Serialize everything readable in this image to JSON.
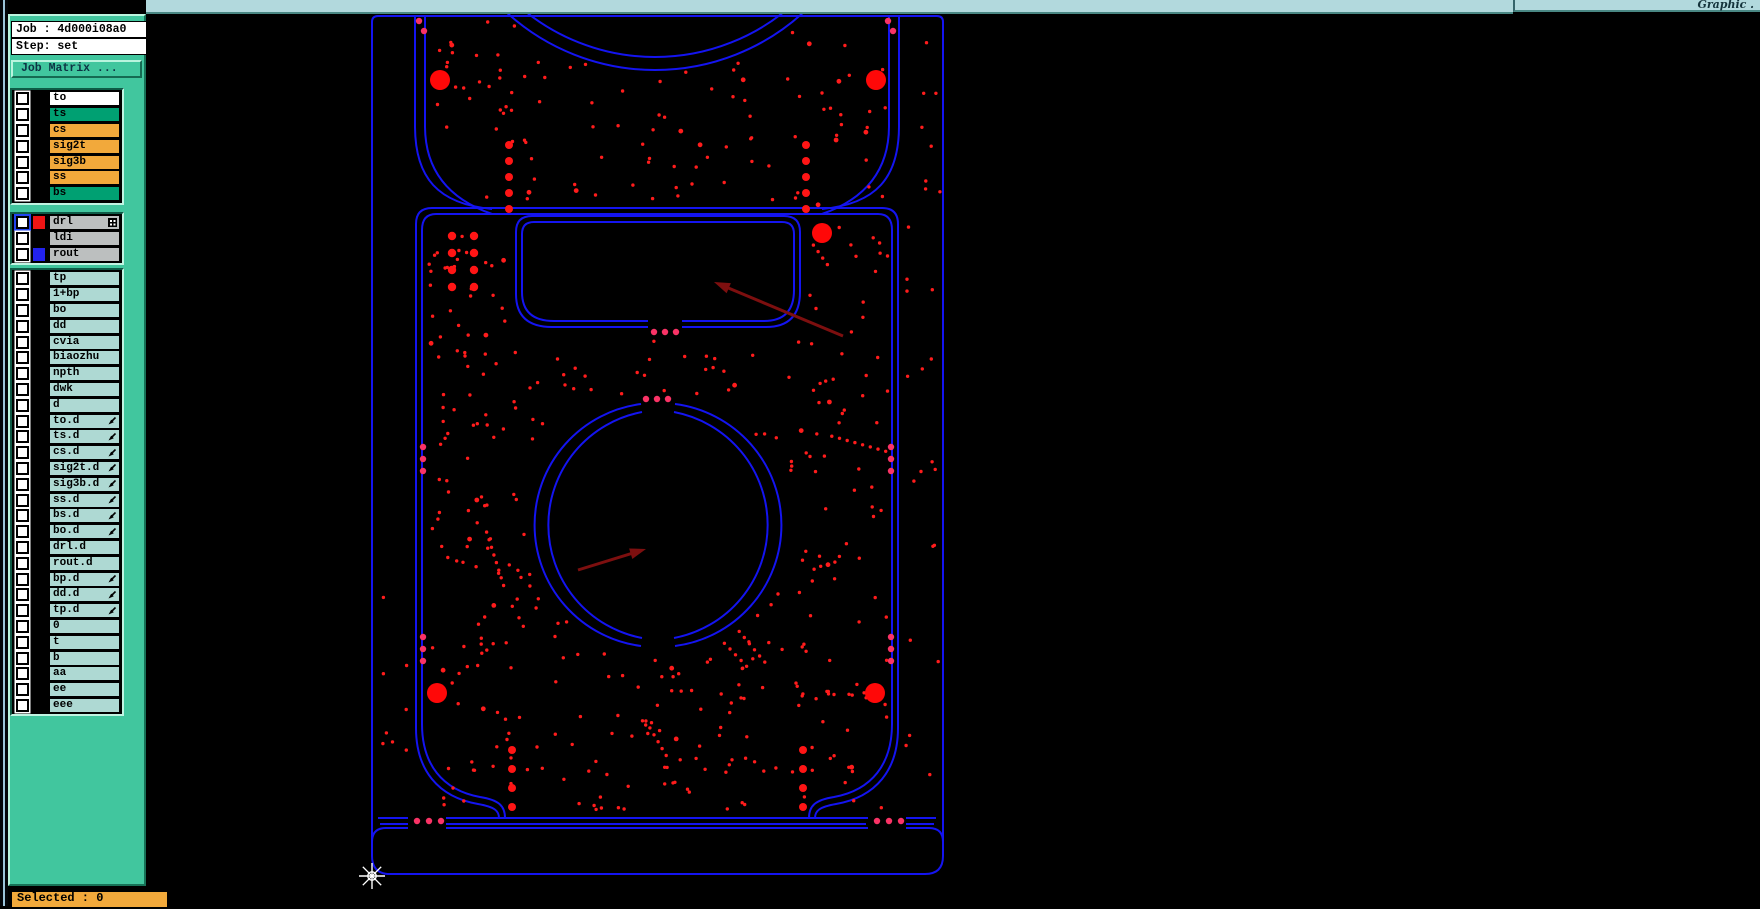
{
  "window": {
    "top_bar_right_label": "Graphic ."
  },
  "job_panel": {
    "job_line": "Job : 4d000i08a0",
    "step_line": "Step: set",
    "matrix_button_label": "Job Matrix ..."
  },
  "layers": {
    "groups": [
      {
        "name": "board-layers",
        "rows": [
          {
            "label": "to",
            "bg": "#ffffff"
          },
          {
            "label": "ts",
            "bg": "#00a072"
          },
          {
            "label": "cs",
            "bg": "#f2a93b"
          },
          {
            "label": "sig2t",
            "bg": "#f2a93b"
          },
          {
            "label": "sig3b",
            "bg": "#f2a93b"
          },
          {
            "label": "ss",
            "bg": "#f2a93b"
          },
          {
            "label": "bs",
            "bg": "#00a072"
          }
        ]
      },
      {
        "name": "drill-rout-layers",
        "rows": [
          {
            "label": "drl",
            "bg": "#bcbfbf",
            "swatch": "#ee1515",
            "selected": true,
            "icon": "grid"
          },
          {
            "label": "ldi",
            "bg": "#bcbfbf"
          },
          {
            "label": "rout",
            "bg": "#bcbfbf",
            "swatch": "#2222ee"
          }
        ]
      },
      {
        "name": "misc-layers",
        "rows": [
          {
            "label": "tp"
          },
          {
            "label": "1+bp"
          },
          {
            "label": "bo"
          },
          {
            "label": "dd"
          },
          {
            "label": "cvia"
          },
          {
            "label": "biaozhu"
          },
          {
            "label": "npth"
          },
          {
            "label": "dwk"
          },
          {
            "label": "d"
          },
          {
            "label": "to.d",
            "icon": "pen"
          },
          {
            "label": "ts.d",
            "icon": "pen"
          },
          {
            "label": "cs.d",
            "icon": "pen"
          },
          {
            "label": "sig2t.d",
            "icon": "pen"
          },
          {
            "label": "sig3b.d",
            "icon": "pen"
          },
          {
            "label": "ss.d",
            "icon": "pen"
          },
          {
            "label": "bs.d",
            "icon": "pen"
          },
          {
            "label": "bo.d",
            "icon": "pen"
          },
          {
            "label": "drl.d"
          },
          {
            "label": "rout.d"
          },
          {
            "label": "bp.d",
            "icon": "pen"
          },
          {
            "label": "dd.d",
            "icon": "pen"
          },
          {
            "label": "tp.d",
            "icon": "pen"
          },
          {
            "label": "0"
          },
          {
            "label": "t"
          },
          {
            "label": "b"
          },
          {
            "label": "aa"
          },
          {
            "label": "ee"
          },
          {
            "label": "eee"
          }
        ]
      }
    ],
    "default_row_bg": "#aed9d3"
  },
  "status": {
    "selected_label": "Selected : 0"
  },
  "colors": {
    "sidebar": "#41c69e",
    "topbar": "#b2d9dd",
    "outline_blue": "#1414f0",
    "drill_red": "#ff1c1c",
    "big_drill_red": "#ff0808",
    "tab_drill_pink": "#fa3366",
    "arrow_dark_red": "#7d0f0f",
    "status_orange": "#f2a93b"
  },
  "canvas": {
    "big_drills": [
      [
        440,
        80
      ],
      [
        876,
        80
      ],
      [
        822,
        233
      ],
      [
        437,
        693
      ],
      [
        875,
        693
      ]
    ],
    "medium_drill_columns": [
      {
        "x": 509,
        "ys": [
          145,
          161,
          177,
          193,
          209
        ]
      },
      {
        "x": 806,
        "ys": [
          145,
          161,
          177,
          193,
          209
        ]
      },
      {
        "x": 512,
        "ys": [
          750,
          769,
          788,
          807
        ]
      },
      {
        "x": 803,
        "ys": [
          750,
          769,
          788,
          807
        ]
      }
    ],
    "drill_grid": {
      "xs": [
        452,
        474
      ],
      "ys": [
        236,
        253,
        270,
        287
      ]
    },
    "tab_drills": [
      [
        417,
        821
      ],
      [
        429,
        821
      ],
      [
        441,
        821
      ],
      [
        877,
        821
      ],
      [
        889,
        821
      ],
      [
        901,
        821
      ],
      [
        419,
        21
      ],
      [
        424,
        31
      ],
      [
        888,
        21
      ],
      [
        893,
        31
      ],
      [
        423,
        447
      ],
      [
        423,
        459
      ],
      [
        423,
        471
      ],
      [
        423,
        637
      ],
      [
        423,
        649
      ],
      [
        423,
        661
      ],
      [
        891,
        447
      ],
      [
        891,
        459
      ],
      [
        891,
        471
      ],
      [
        891,
        637
      ],
      [
        891,
        649
      ],
      [
        891,
        661
      ],
      [
        654,
        332
      ],
      [
        665,
        332
      ],
      [
        676,
        332
      ],
      [
        646,
        399
      ],
      [
        657,
        399
      ],
      [
        668,
        399
      ]
    ],
    "arrows": [
      {
        "from": [
          843,
          336
        ],
        "to": [
          714,
          282
        ]
      },
      {
        "from": [
          578,
          570
        ],
        "to": [
          646,
          549
        ]
      }
    ],
    "cursor": [
      372,
      876
    ]
  }
}
